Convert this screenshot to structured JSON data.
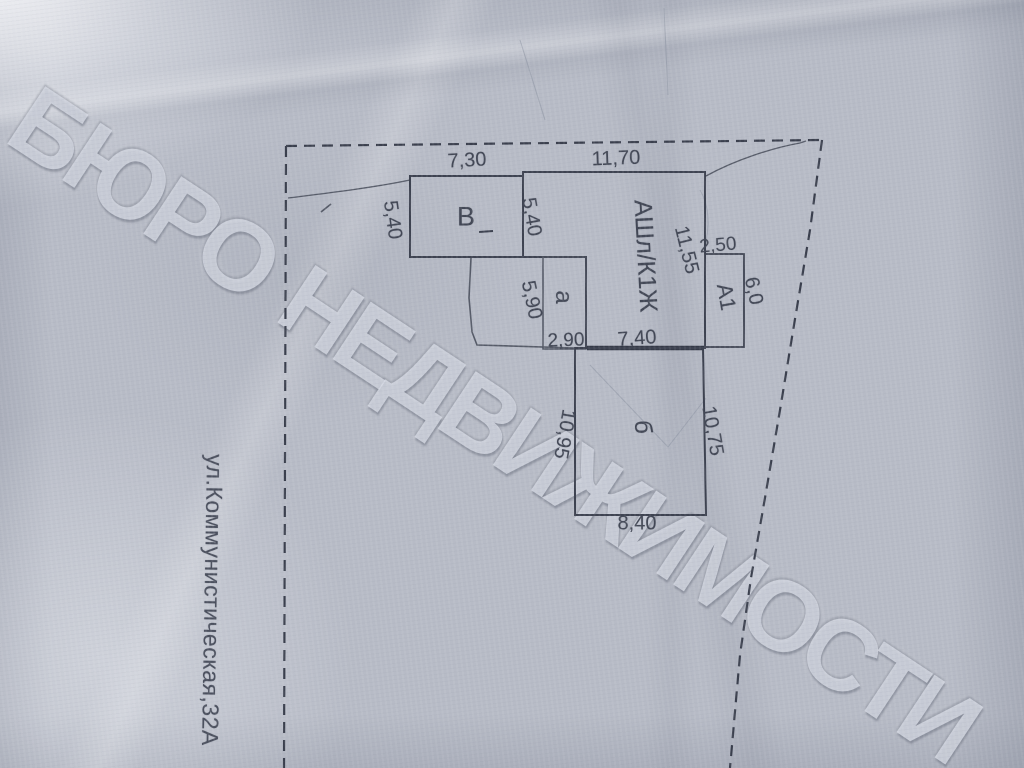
{
  "document": {
    "watermark": "БЮРО НЕДВИЖИМОСТИ",
    "street_label": "ул.Коммунистическая,32А"
  },
  "plan": {
    "building_labels": {
      "main": "АШл/К1Ж",
      "v": "В",
      "a1": "А1",
      "a": "а",
      "b": "б"
    },
    "dimensions": {
      "v_top": "7,30",
      "main_top": "11,70",
      "v_left": "5,40",
      "main_left_inner": "5,40",
      "main_right": "11,55",
      "a1_top": "2,50",
      "a1_right": "6,0",
      "a_left": "5,90",
      "a_bottom": "2,90",
      "main_bottom": "7,40",
      "b_left": "10,95",
      "b_right": "10,75",
      "b_bottom": "8,40"
    },
    "colors": {
      "ink": "#3d4250",
      "paper": "#b7bbc6"
    }
  }
}
